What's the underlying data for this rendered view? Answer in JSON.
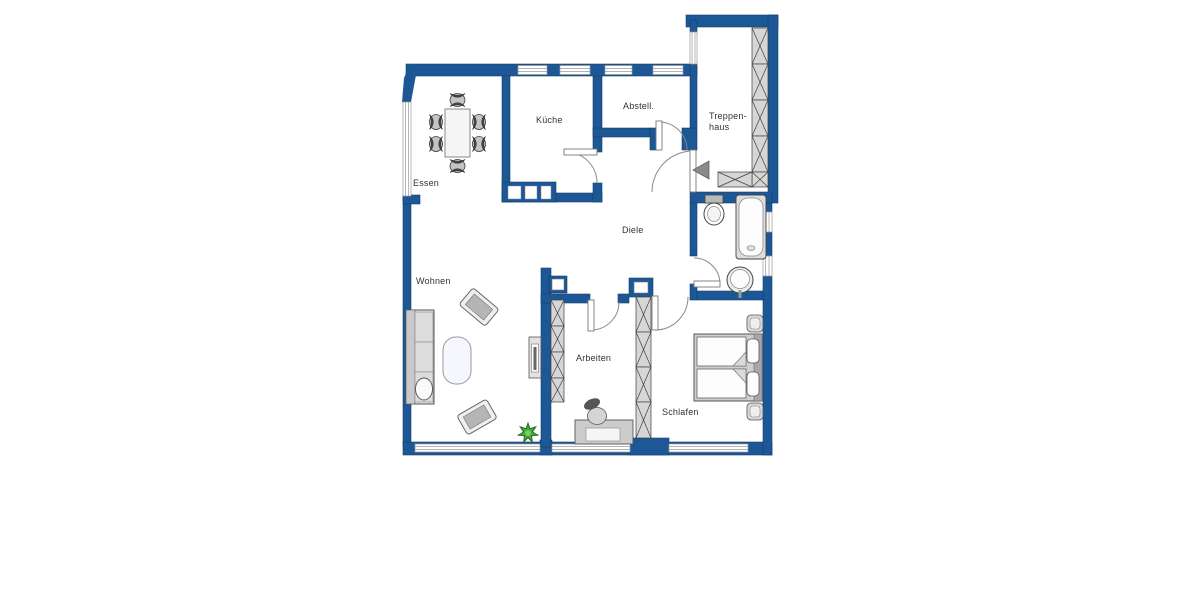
{
  "plan": {
    "type": "apartment-floor-plan",
    "rooms": {
      "essen": {
        "label": "Essen"
      },
      "kueche": {
        "label": "Küche"
      },
      "abstell": {
        "label": "Abstell."
      },
      "treppenhaus": {
        "label_line1": "Treppen-",
        "label_line2": "haus"
      },
      "diele": {
        "label": "Diele"
      },
      "wohnen": {
        "label": "Wohnen"
      },
      "arbeiten": {
        "label": "Arbeiten"
      },
      "schlafen": {
        "label": "Schlafen"
      }
    },
    "colors": {
      "wall_blue": "#1e5796",
      "wall_outline": "#11406f",
      "hatch_gray": "#d6d6d6",
      "furniture_gray": "#c9c9c9",
      "plant_green": "#4aa83e",
      "background": "#ffffff",
      "label_text": "#333333"
    },
    "fixtures": [
      "dining-table",
      "dining-chairs",
      "sofa",
      "coffee-table",
      "armchairs",
      "tv-board",
      "plant",
      "desk",
      "office-chair",
      "double-bed",
      "nightstands",
      "toilet",
      "bathtub",
      "sink",
      "staircase",
      "entrance-arrow"
    ]
  }
}
